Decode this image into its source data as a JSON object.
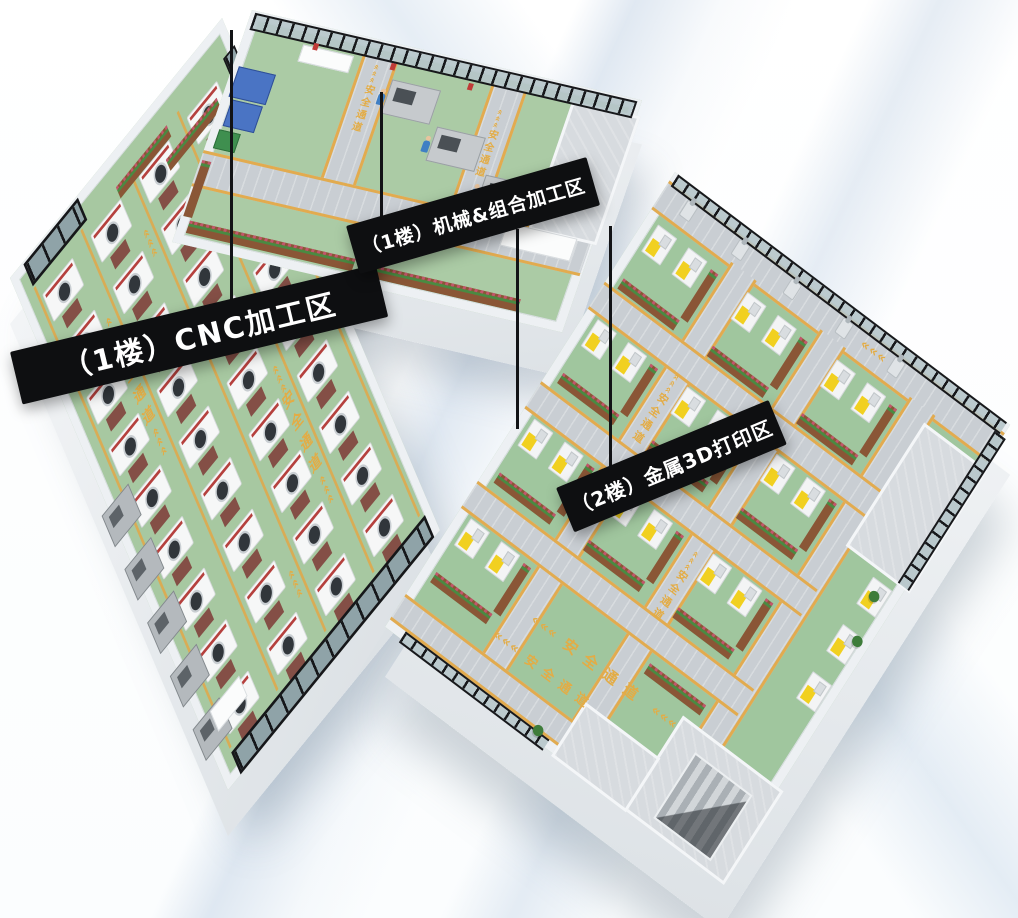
{
  "areas": [
    {
      "id": "cnc",
      "label": "（1楼）CNC加工区"
    },
    {
      "id": "mechanical",
      "label": "（1楼）机械&组合加工区"
    },
    {
      "id": "metal-3d-print",
      "label": "（2楼）金属3D打印区"
    }
  ],
  "floor_markings": {
    "safety_lane_text": "安全通道",
    "lane_chevrons": "«««"
  },
  "counts": {
    "cnc_machines_per_column": 9,
    "cnc_side_machines": 5,
    "printers_per_cell": 2,
    "wall_printers": 3,
    "robot_arms": 5
  },
  "colors": {
    "floor_green": "#a7c8a1",
    "walkway_gray": "#c9ced3",
    "lane_marking_yellow": "#e2ab4f",
    "floor_text_yellow": "#e3ac45",
    "label_banner_black": "#0e0f11",
    "label_text_white": "#ffffff",
    "wall_white": "#eef1f4",
    "window_frame_black": "#1b1d1f",
    "machine_white": "#f5f6f7",
    "machine_accent_red": "#b5413e",
    "printer_accent_yellow": "#f1d020",
    "worker_uniform_blue": "#3f7fc4",
    "planter_brown": "#8a5636",
    "plant_green": "#3f7c3b"
  }
}
